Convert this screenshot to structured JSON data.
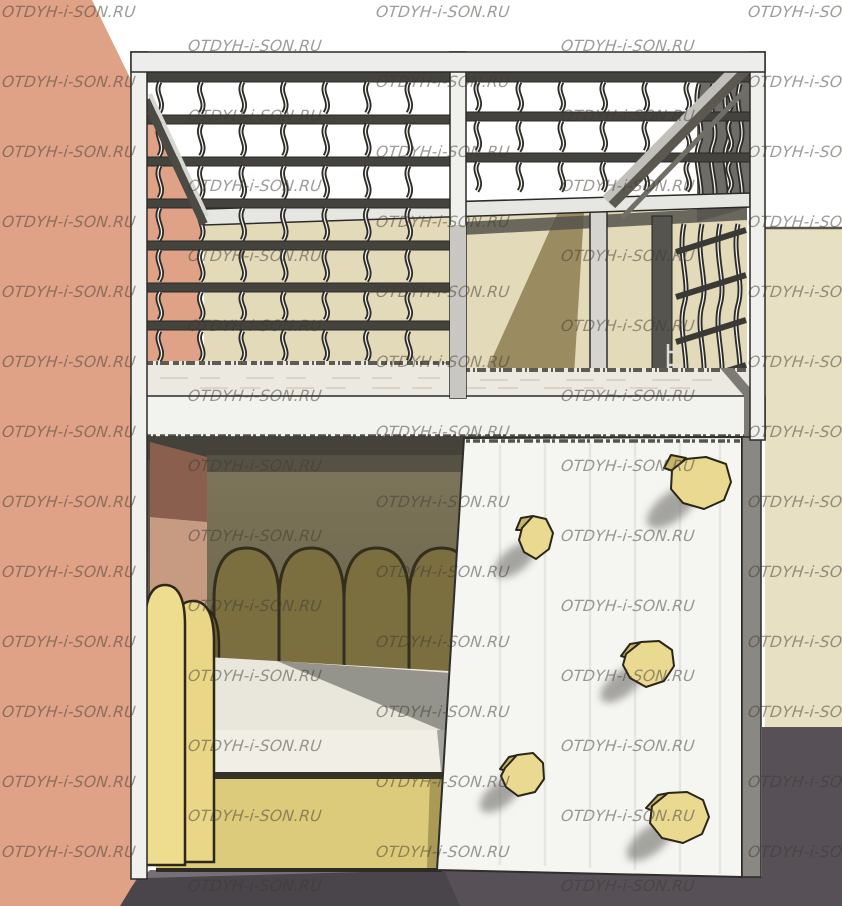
{
  "watermark": {
    "text": "OTDYH-i-SON.RU",
    "color": "rgba(62,58,50,0.5)",
    "font_size_px": 15.5,
    "grid": {
      "column_x": [
        2,
        188,
        376,
        561,
        748
      ],
      "row_step": 70,
      "rows_per_column": 13,
      "phase_odd_columns": 3,
      "phase_even_columns": 37
    }
  },
  "scene": {
    "description": "3D render of a children's loft bed: upper level enclosed by a lattice of bent slats with a diagonal brace and an entry opening, a lower bed with arched cushions and a yellow drawer base, and a white climbing wall with five yellow holds, set in a room corner with a salmon wall, a beige wall and a dark violet floor.",
    "objects": [
      "left-wall",
      "right-wall",
      "floor",
      "loft-frame",
      "safety-lattice",
      "loft-opening",
      "diagonal-brace",
      "upper-mattress",
      "platform-fascia",
      "lower-bunk",
      "headboard-arches",
      "lower-mattress",
      "bed-base",
      "side-arches",
      "climbing-wall",
      "climbing-holds"
    ],
    "climbing_holds_count": 5,
    "headboard_arches_count": 4
  },
  "palette": {
    "salmon": "#dfa287",
    "salmon_deep": "#c79a82",
    "beige": "#e7e0c2",
    "beige_back": "#e2dab8",
    "floor": "#575057",
    "floor_shadow": "#464047",
    "frame_white": "#f0f0ed",
    "frame_white_dim": "#e6e6e2",
    "panel_gray": "#6e6c66",
    "mid_gray": "#8a8882",
    "rail_dark": "#45433e",
    "outline": "#2a2926",
    "slat": "#2e2c28",
    "slat_core": "#f4f4f1",
    "mattress": "#ebe9e0",
    "mattress_shadow": "#8f8f88",
    "olive_wall": "#7b7357",
    "olive_dark": "#565243",
    "arch_olive": "#7b6f40",
    "arch_outline": "#342e1d",
    "maroon": "#8b5f4d",
    "bed_yellow": "#dccb7a",
    "bed_yellow_dark": "#9c8d4d",
    "arch_yellow": "#e9d687",
    "arch_yellow2": "#efdd8f",
    "hold": "#ead990",
    "hold_dark": "#c6b468",
    "wall_white": "#f5f5f2",
    "grain": "#e4e4df",
    "shadow_diag": "#8d7d50",
    "brace": "#5a584f",
    "wm_color": "rgba(62,58,50,0.5)"
  }
}
